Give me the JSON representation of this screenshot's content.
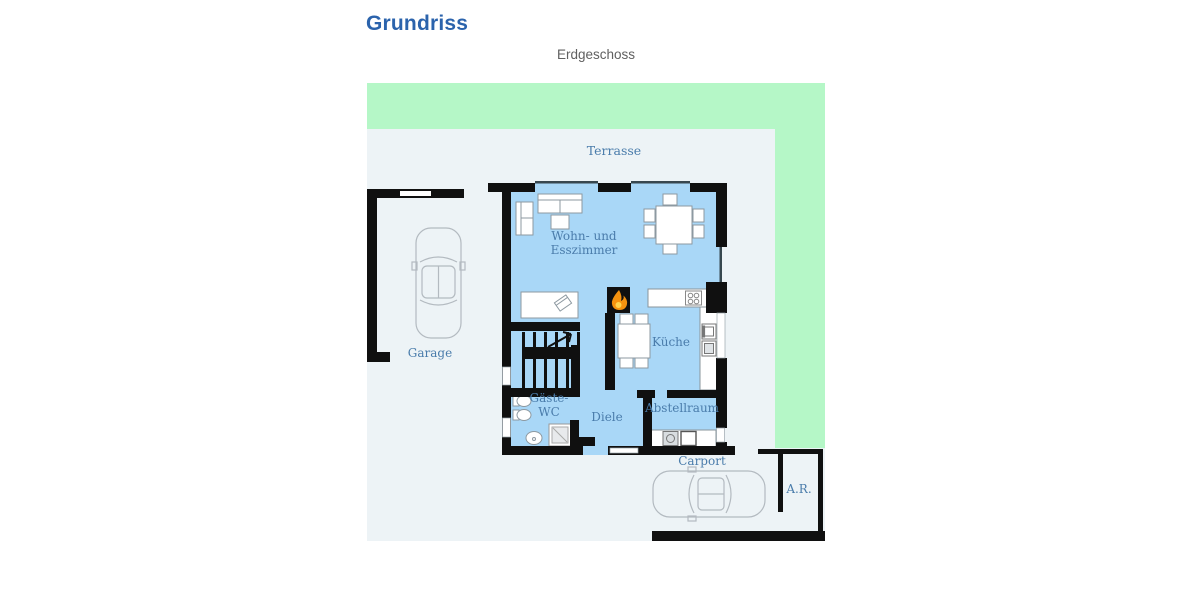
{
  "page": {
    "title": "Grundriss",
    "subtitle": "Erdgeschoss"
  },
  "rooms": {
    "terrasse": "Terrasse",
    "wohnzimmer_line1": "Wohn- und",
    "wohnzimmer_line2": "Esszimmer",
    "kueche": "Küche",
    "diele": "Diele",
    "gaeste_wc_line1": "Gäste-",
    "gaeste_wc_line2": "WC",
    "abstellraum": "Abstellraum",
    "garage": "Garage",
    "carport": "Carport",
    "abstellraum_aussen": "A.R."
  },
  "icons": {
    "fireplace": "flame-icon",
    "stairs_direction": "up-arrow-icon"
  },
  "colors": {
    "garden_green": "#b5f7c7",
    "lot_gray": "#edf3f6",
    "room_blue": "#a9d7f7",
    "wall_black": "#101010",
    "label_blue": "#4a7cab",
    "title_blue": "#2b63ac",
    "subtitle_gray": "#606060",
    "flame_orange": "#f5920f",
    "flame_yellow": "#ffd34d"
  }
}
